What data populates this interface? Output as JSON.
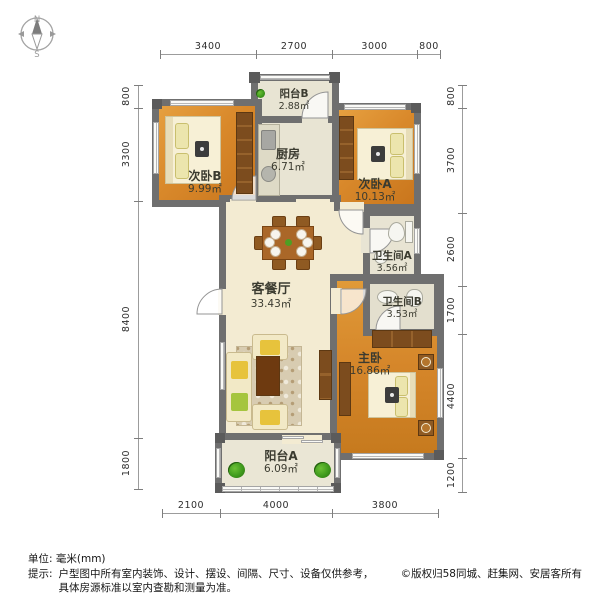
{
  "compass": {
    "north": "N",
    "south": "S"
  },
  "rooms": {
    "balcony_b": {
      "name": "阳台B",
      "area": "2.88㎡"
    },
    "kitchen": {
      "name": "厨房",
      "area": "6.71㎡"
    },
    "bedroom_b": {
      "name": "次卧B",
      "area": "9.99㎡"
    },
    "bedroom_a": {
      "name": "次卧A",
      "area": "10.13㎡"
    },
    "bathroom_a": {
      "name": "卫生间A",
      "area": "3.56㎡"
    },
    "bathroom_b": {
      "name": "卫生间B",
      "area": "3.53㎡"
    },
    "living": {
      "name": "客餐厅",
      "area": "33.43㎡"
    },
    "master": {
      "name": "主卧",
      "area": "16.86㎡"
    },
    "balcony_a": {
      "name": "阳台A",
      "area": "6.09㎡"
    }
  },
  "dims": {
    "top": [
      "3400",
      "2700",
      "3000",
      "800"
    ],
    "left": [
      "800",
      "3300",
      "8400",
      "1800"
    ],
    "right": [
      "800",
      "3700",
      "2600",
      "1700",
      "4400",
      "1200"
    ],
    "bottom": [
      "2100",
      "4000",
      "3800"
    ]
  },
  "footer": {
    "unit": "单位: 毫米(mm)",
    "tip_label": "提示:",
    "tip_line1": "户型图中所有室内装饰、设计、摆设、间隔、尺寸、设备仅供参考，",
    "tip_line2": "具体房源标准以室内查勘和测量为准。",
    "copyright": "©版权归58同城、赶集网、安居客所有"
  },
  "colors": {
    "wall": "#6f6f6f",
    "wood_floor": "#d9892b",
    "tile_floor": "#e8e4d3",
    "living_floor": "#f3ebd2",
    "label_text": "#3b3b30"
  }
}
